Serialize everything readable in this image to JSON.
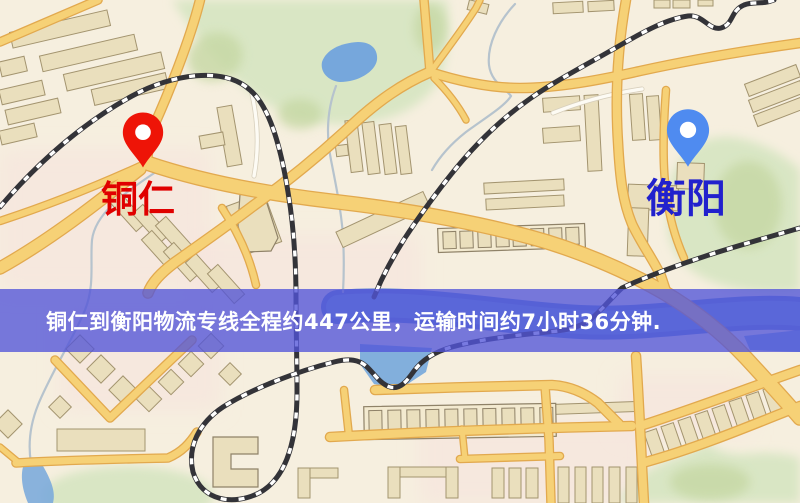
{
  "app": {
    "title": "铜仁到衡阳物流专线地图"
  },
  "map": {
    "palette": {
      "background": "#f6efdf",
      "pink_patch": "rgba(246,226,222,0.60)",
      "green": "#d9e6c4",
      "green_dark": "#c6d8a4",
      "water": "#76a7dc",
      "water_deep": "#5f86cc",
      "stream": "#b6c3cd",
      "road_fill": "#f6d176",
      "road_casing": "#e2a94e",
      "white_road_fill": "#fdfbf4",
      "white_road_casing": "#d8d0bd",
      "rail_dark": "#333338",
      "rail_light": "#ffffff",
      "building_fill": "#eadfbd",
      "building_stroke": "#a3946f",
      "strip_fill": "#f3ead0",
      "strip_stroke": "#8f8268"
    }
  },
  "markers": {
    "origin": {
      "name": "铜仁",
      "pin_color": "#ee1407",
      "pin_shadow": "#b80d04",
      "label_color": "#e00000"
    },
    "destination": {
      "name": "衡阳",
      "pin_color": "#4f8bf0",
      "pin_shadow": "#3a6fd0",
      "label_color": "#2121cd"
    }
  },
  "route": {
    "origin": "铜仁",
    "destination": "衡阳",
    "distance_km": 447,
    "duration": "7小时36分钟"
  },
  "banner": {
    "text": "铜仁到衡阳物流专线全程约447公里，运输时间约7小时36分钟.",
    "background": "rgba(82,84,216,0.78)",
    "text_color": "#ffffff"
  }
}
